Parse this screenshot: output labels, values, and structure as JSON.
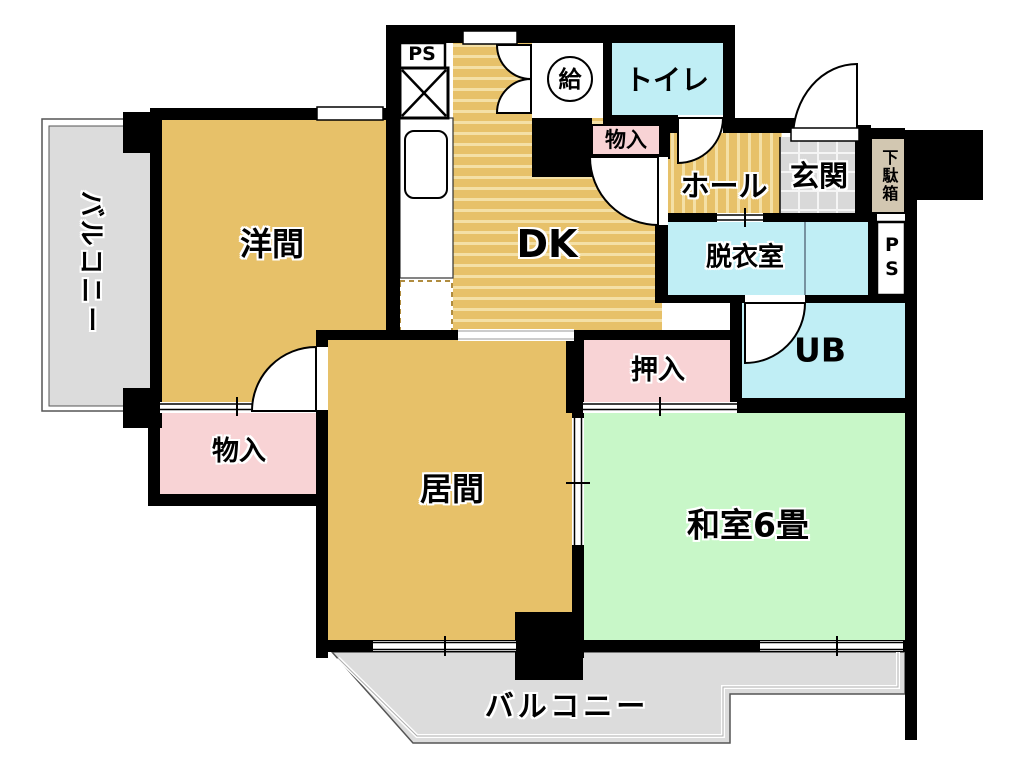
{
  "title": "間取り図",
  "labels": {
    "western_room": "洋間",
    "dining_kitchen": "DK",
    "living_room": "居間",
    "japanese_room": "和室6畳",
    "toilet": "トイレ",
    "hall": "ホール",
    "entrance": "玄関",
    "shoe_cabinet": "下駄箱",
    "dressing_room": "脱衣室",
    "unit_bath": "UB",
    "closet": "押入",
    "storage_top": "物入",
    "storage_left": "物入",
    "balcony_left": "バルコニー",
    "balcony_bottom": "バルコニー",
    "pipe_space_top": "PS",
    "pipe_space_right": "PS",
    "water_heater": "給"
  },
  "colors": {
    "wall": "#000000",
    "room_tan": "#e7c169",
    "stripe_light": "#f4e0a6",
    "pink": "#f8d3d5",
    "cyan": "#c0eef5",
    "green": "#c8f7c8",
    "balcony_gray": "#dcdcdc",
    "tile_gray": "#d9d9d9",
    "shoe_cabinet_beige": "#d2c7b1",
    "outline_gray": "#555555"
  }
}
